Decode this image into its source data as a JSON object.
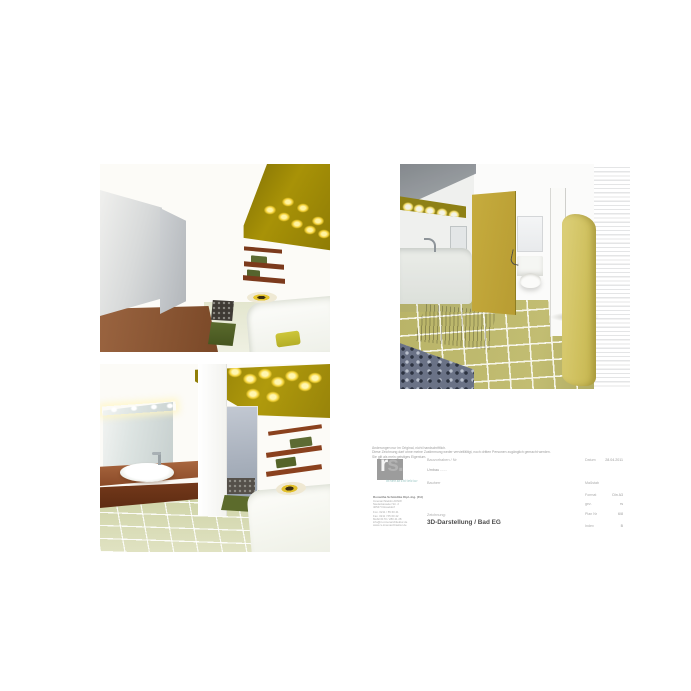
{
  "colors": {
    "accent_olive": "#a89207",
    "tile_green": "#d2d6aa",
    "shelf_brown": "#8a411e",
    "counter_brown": "#8a4a28",
    "logo_gray": "#9c9c9c",
    "logo_teal": "#8fc0bd",
    "light_yellow": "#f4d33a"
  },
  "disclaimer": {
    "lines": [
      "Änderungen nur im Original, nicht handschriftlich.",
      "Diese Zeichnung darf ohne meine Zustimmung weder vervielfältigt, noch dritten Personen zugänglich gemacht werden.",
      "Sie gilt als mein geistiges Eigentum."
    ]
  },
  "logo": {
    "letter_r": "r",
    "letter_s": "s.",
    "subtitle": "innenarchitektur"
  },
  "title_block": {
    "project_label": "Bauvorhaben / Nr",
    "project_value": "Umbau ......",
    "client_label": "Bauherr",
    "drawing_label": "Zeichnung:",
    "drawing_title": "3D-Darstellung / Bad EG",
    "meta_rows": [
      {
        "label": "Datum",
        "value": "28.04.2011"
      },
      {
        "label": "Maßstab",
        "value": ""
      },
      {
        "label": "Format",
        "value": "Din A3"
      },
      {
        "label": "gez.",
        "value": "rs"
      },
      {
        "label": "Plan Nr",
        "value": "6/8"
      },
      {
        "label": "Index",
        "value": "B"
      }
    ],
    "address": {
      "name": "Roswitha Schmidtke Dipl.-Ing. (FH)",
      "lines": [
        "Innenarchitektin AKNW",
        "Niederkasseler Str. 2",
        "40547 Düsseldorf"
      ],
      "contact": [
        "Fon. 0211 / 55 60 41",
        "Fax. 0211 / 55 60 42",
        "Mobil 0170 / 280 41 28",
        "info@rs-innenarchitektur.de",
        "www.rs-innenarchitektur.de"
      ]
    }
  }
}
